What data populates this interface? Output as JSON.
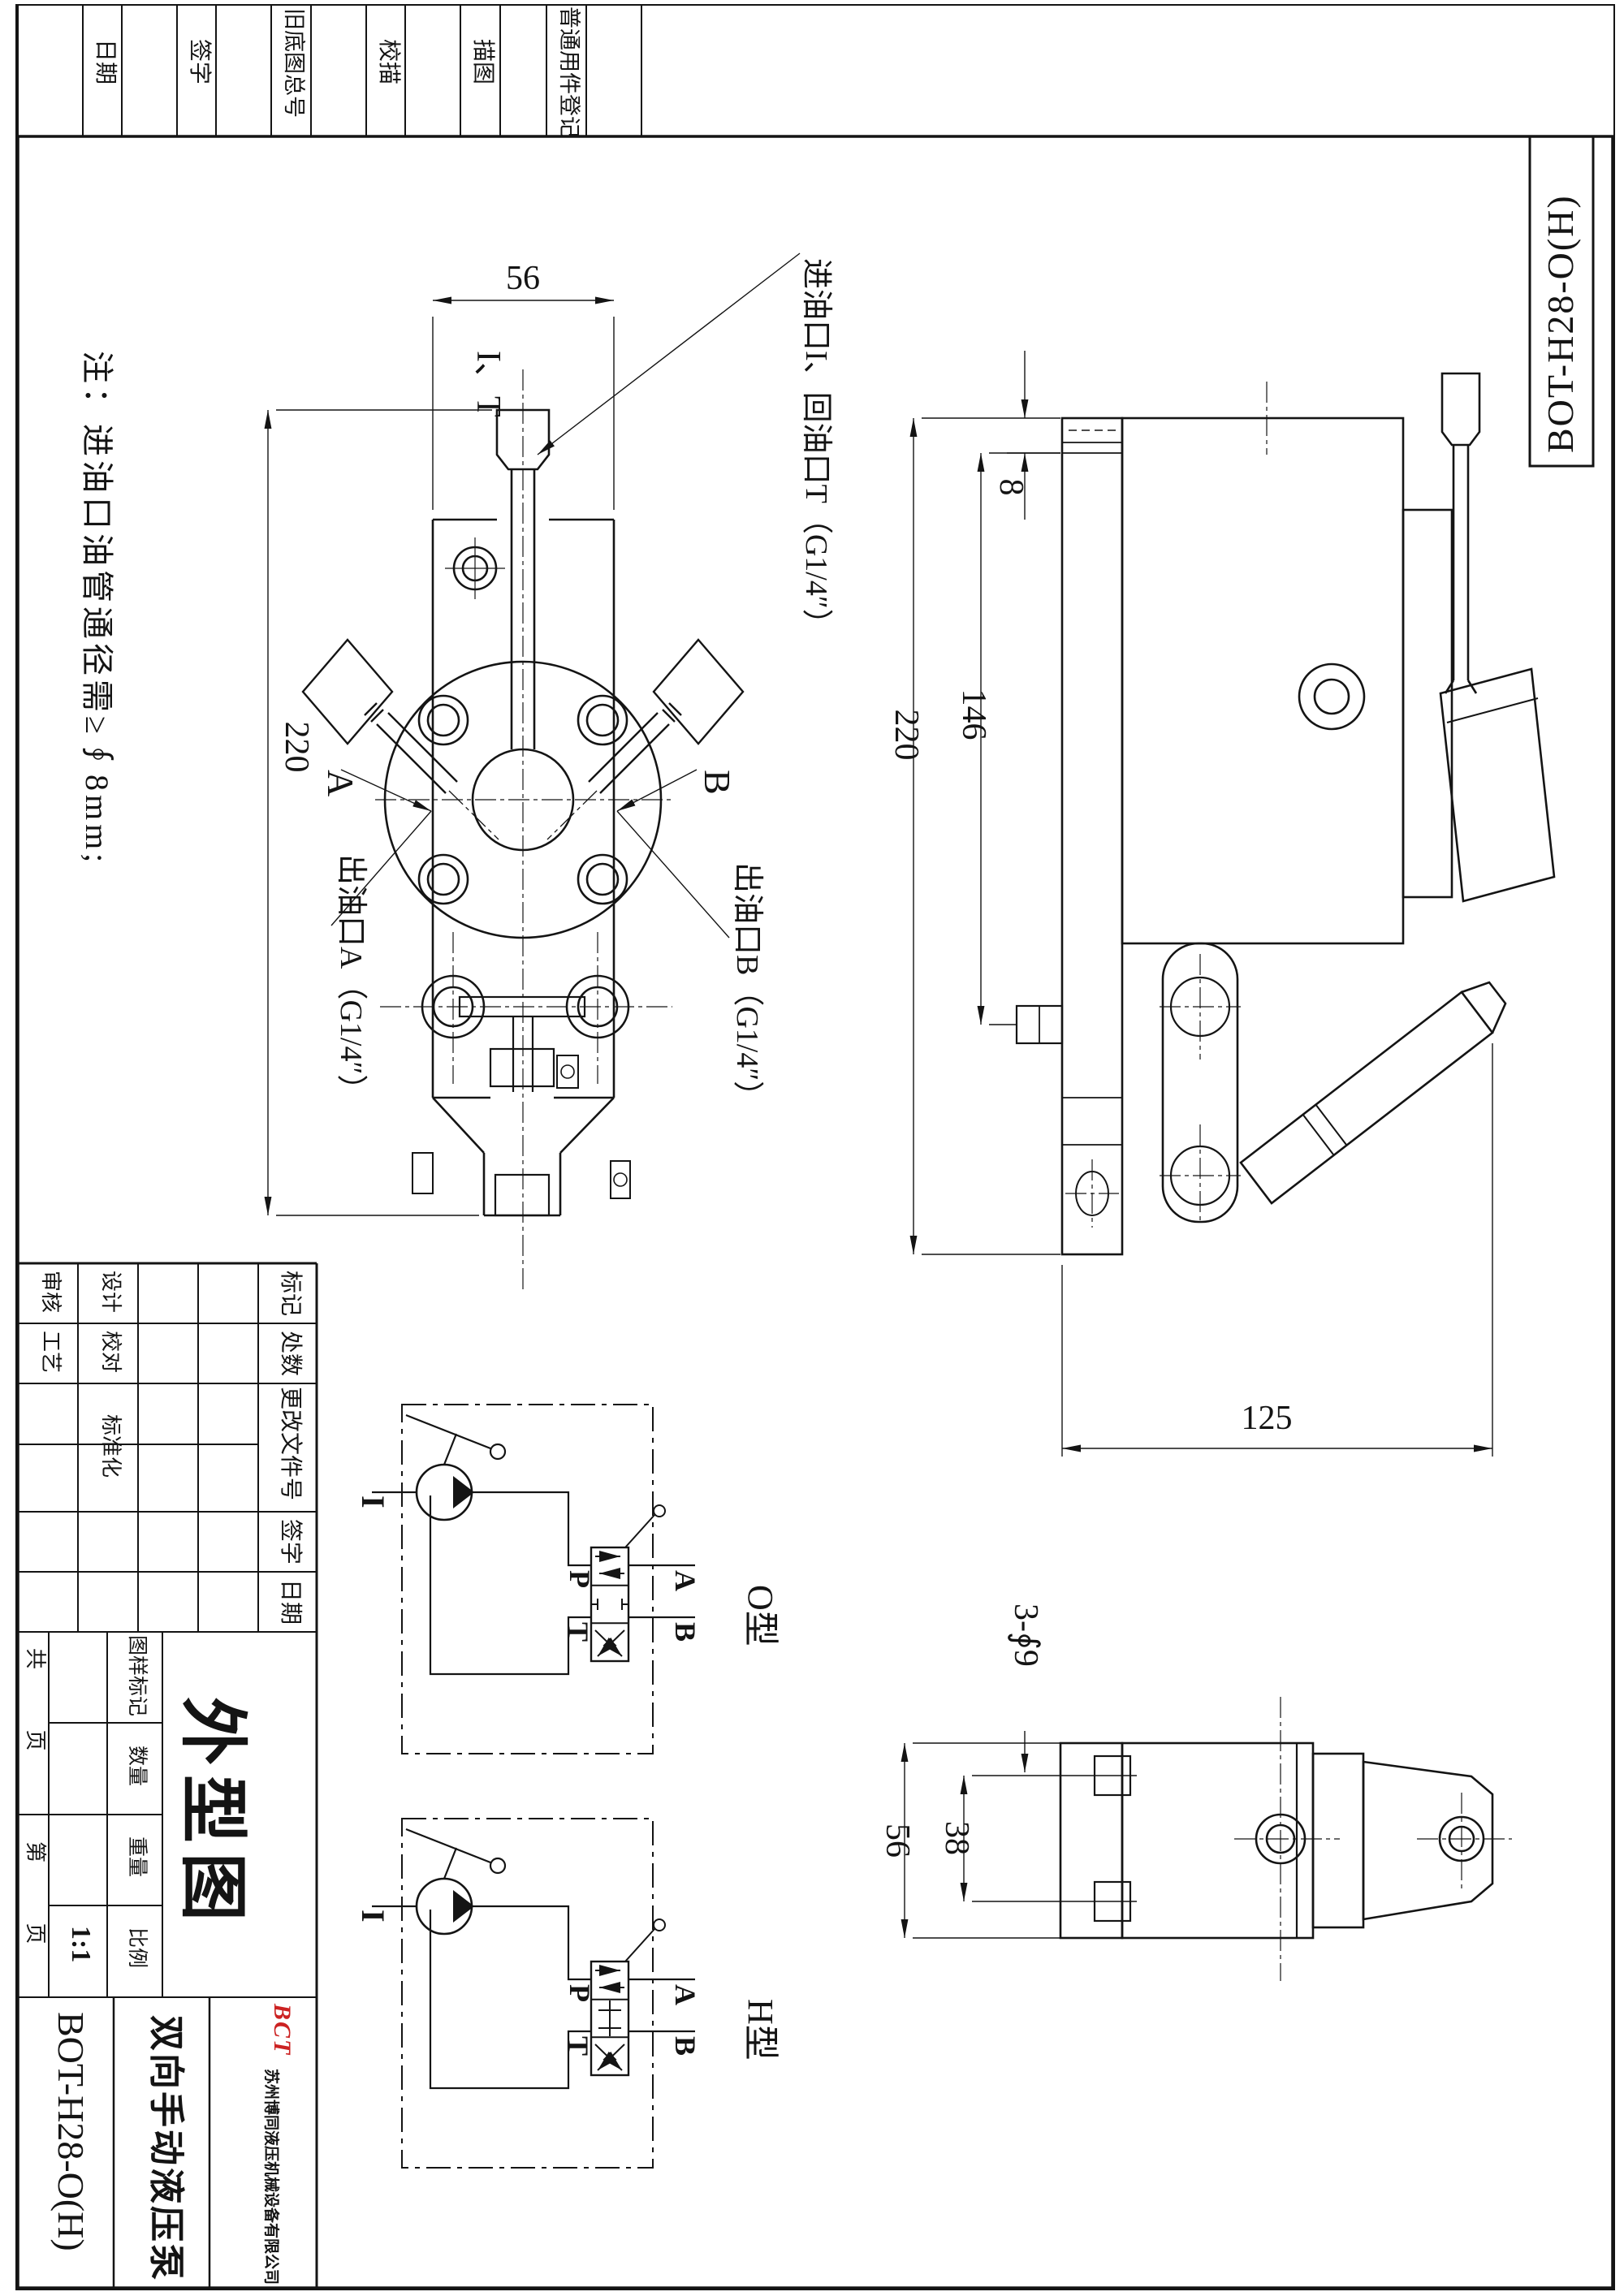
{
  "sheet": {
    "background": "#ffffff",
    "line_color": "#141414"
  },
  "top_strip": {
    "labels": [
      "日期",
      "签字",
      "旧底图总号",
      "校描",
      "描图",
      "普通用件登记"
    ]
  },
  "corner_box": {
    "drawing_no": "BOT-H28-O(H)"
  },
  "note": {
    "text": "注：进油口油管通径需≥∮8mm;"
  },
  "front_view": {
    "dim_width": "56",
    "dim_height": "220",
    "port_label": "I、T",
    "label_a": "A",
    "label_b": "B",
    "callout_inlet": "进油口I、回油口T（G1/4″）",
    "callout_outlet_a": "出油口A（G1/4″）",
    "callout_outlet_b": "出油口B（G1/4″）"
  },
  "side_view": {
    "dim_plate_thickness": "8",
    "dim_mid": "146",
    "dim_height": "220",
    "dim_depth": "125"
  },
  "bottom_view": {
    "dim_holes": "3-∮9",
    "dim_hole_span": "38",
    "dim_width": "56"
  },
  "schematic_o": {
    "label_i": "I",
    "label_p": "P",
    "label_t": "T",
    "label_a": "A",
    "label_b": "B",
    "type_label": "O型"
  },
  "schematic_h": {
    "label_i": "I",
    "label_p": "P",
    "label_t": "T",
    "label_a": "A",
    "label_b": "B",
    "type_label": "H型"
  },
  "title_block": {
    "review": "审核",
    "process": "工艺",
    "design": "设计",
    "check": "校对",
    "standard": "标准化",
    "mark": "标记",
    "count": "处数",
    "change_doc": "更改文件号",
    "sign": "签字",
    "date": "日期",
    "stamp": "图样标记",
    "quantity": "数量",
    "weight": "重量",
    "scale": "比例",
    "scale_value": "1:1",
    "total_pages": "共  页",
    "page_no": "第  页",
    "drawing_title": "外型图",
    "product_name": "双向手动液压泵",
    "drawing_no": "BOT-H28-O(H)",
    "company": "苏州博同液压机械设备有限公司",
    "logo": "BCT"
  }
}
